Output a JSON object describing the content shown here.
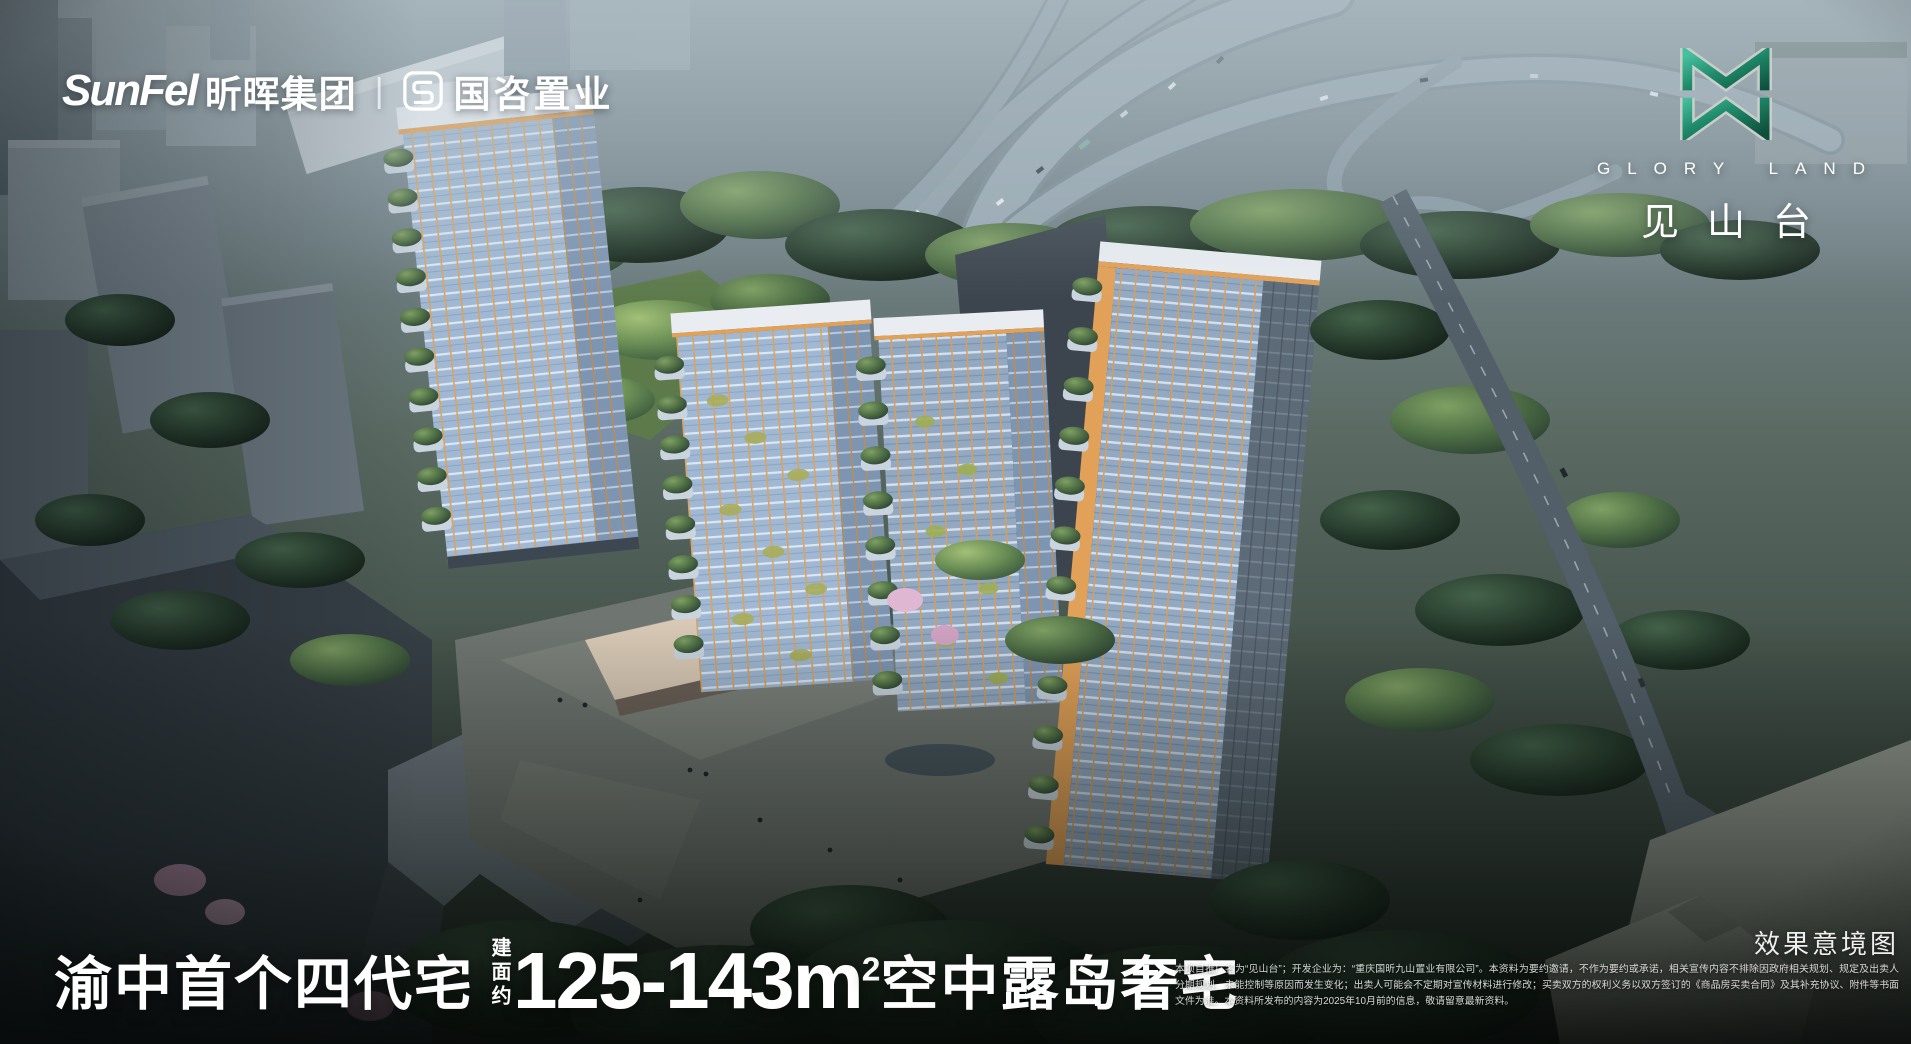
{
  "brand_left": {
    "sunfel_en": "SunFel",
    "sunfel_cn": "昕晖集团",
    "divider": "|",
    "guozi_icon": "guozi-seal-icon",
    "guozi_name": "国咨置业"
  },
  "brand_right": {
    "emblem_icon": "glory-land-emblem-icon",
    "en_name": "GLORY LAND",
    "cn_name": "见山台"
  },
  "headline": {
    "prefix": "渝中首个四代宅",
    "area_label": "建面约",
    "area_range": "125-143m",
    "area_sup": "2",
    "suffix": "空中露岛奢宅"
  },
  "watermark": "效果意境图",
  "disclaimer": "本项目推广名为“见山台”；开发企业为：“重庆国昕九山置业有限公司”。本资料为要约邀请，不作为要约或承诺，相关宣传内容不排除因政府相关规划、规定及出卖人分期规划、未能控制等原因而发生变化；出卖人可能会不定期对宣传材料进行修改；买卖双方的权利义务以双方签订的《商品房买卖合同》及其补充协议、附件等书面文件为准。本资料所发布的内容为2025年10月前的信息，敬请留意最新资料。",
  "colors": {
    "emblem_green": "#1f8a6b",
    "emblem_green_dark": "#0e4f3c",
    "facade_orange": "#e2a158",
    "glass_blue": "#9db6d2",
    "text_white": "#ffffff"
  }
}
